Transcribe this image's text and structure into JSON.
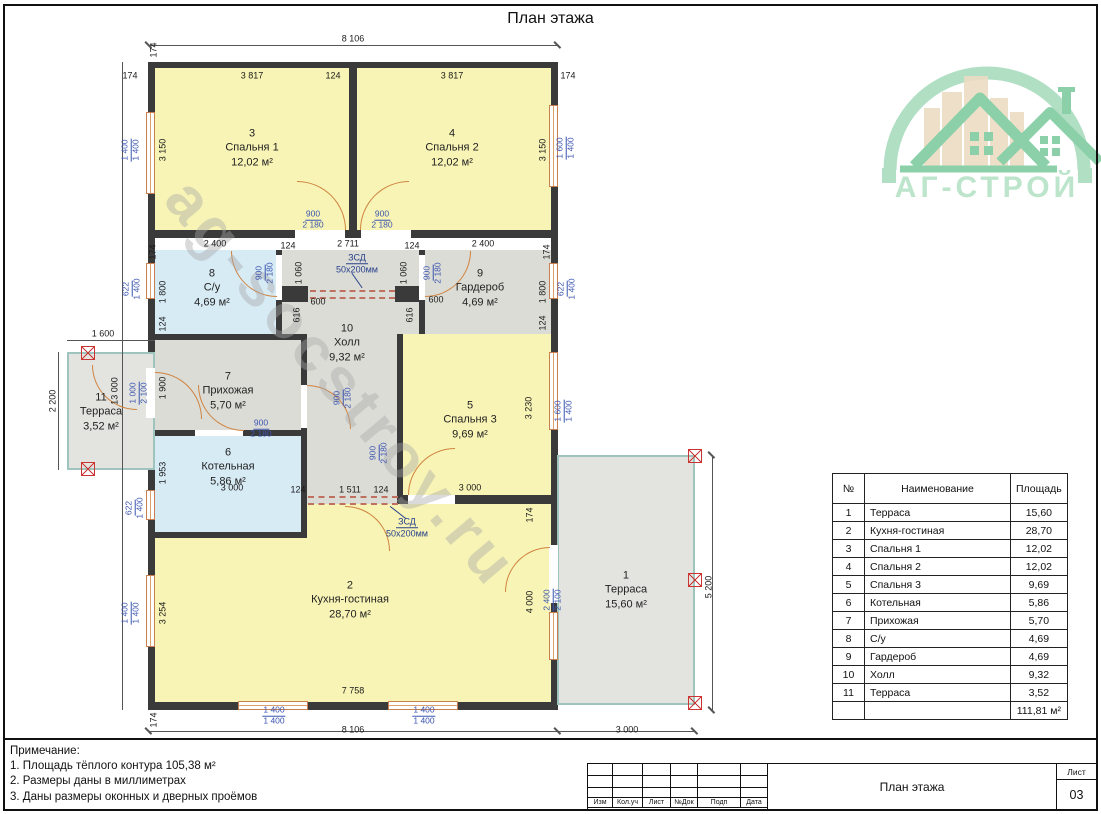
{
  "page": {
    "title": "План этажа"
  },
  "logo": {
    "name": "АГ-СТРОЙ"
  },
  "watermark": "ag-socstroy.ru",
  "plan": {
    "rooms": [
      {
        "num": "3",
        "name": "Спальня 1",
        "area": "12,02 м²"
      },
      {
        "num": "4",
        "name": "Спальня 2",
        "area": "12,02 м²"
      },
      {
        "num": "8",
        "name": "С/у",
        "area": "4,69 м²"
      },
      {
        "num": "9",
        "name": "Гардероб",
        "area": "4,69 м²"
      },
      {
        "num": "10",
        "name": "Холл",
        "area": "9,32 м²"
      },
      {
        "num": "7",
        "name": "Прихожая",
        "area": "5,70 м²"
      },
      {
        "num": "5",
        "name": "Спальня 3",
        "area": "9,69 м²"
      },
      {
        "num": "6",
        "name": "Котельная",
        "area": "5,86 м²"
      },
      {
        "num": "2",
        "name": "Кухня-гостиная",
        "area": "28,70 м²"
      },
      {
        "num": "11",
        "name": "Терраса",
        "area": "3,52 м²"
      },
      {
        "num": "1",
        "name": "Терраса",
        "area": "15,60 м²"
      }
    ],
    "dims": [
      "8 106",
      "174",
      "174",
      "3 817",
      "124",
      "3 817",
      "174",
      "3 150",
      "1 400",
      "1 400",
      "3 150",
      "1 600",
      "1 400",
      "900",
      "2 180",
      "900",
      "2 180",
      "2 400",
      "124",
      "2 711",
      "124",
      "2 400",
      "174",
      "174",
      "1 060",
      "1 060",
      "900",
      "2 180",
      "900",
      "2 180",
      "1 800",
      "622",
      "1 400",
      "1 800",
      "622",
      "1 400",
      "ЗСД",
      "50х200мм",
      "600",
      "616",
      "600",
      "616",
      "124",
      "124",
      "1 600",
      "2 200",
      "13 000",
      "1 900",
      "1 000",
      "2 100",
      "900",
      "2 180",
      "900",
      "2 180",
      "3 230",
      "1 600",
      "1 400",
      "900",
      "2 180",
      "1 953",
      "622",
      "1 400",
      "3 000",
      "124",
      "1 511",
      "124",
      "3 000",
      "ЗСД",
      "50х200мм",
      "174",
      "3 254",
      "1 400",
      "1 400",
      "4 000",
      "2 400",
      "2 100",
      "5 200",
      "3 000",
      "7 758",
      "8 106",
      "1 400",
      "1 400",
      "1 400",
      "1 400",
      "174"
    ]
  },
  "table": {
    "headers": [
      "№",
      "Наименование",
      "Площадь"
    ],
    "rows": [
      {
        "num": "1",
        "name": "Терраса",
        "area": "15,60"
      },
      {
        "num": "2",
        "name": "Кухня-гостиная",
        "area": "28,70"
      },
      {
        "num": "3",
        "name": "Спальня 1",
        "area": "12,02"
      },
      {
        "num": "4",
        "name": "Спальня 2",
        "area": "12,02"
      },
      {
        "num": "5",
        "name": "Спальня 3",
        "area": "9,69"
      },
      {
        "num": "6",
        "name": "Котельная",
        "area": "5,86"
      },
      {
        "num": "7",
        "name": "Прихожая",
        "area": "5,70"
      },
      {
        "num": "8",
        "name": "С/у",
        "area": "4,69"
      },
      {
        "num": "9",
        "name": "Гардероб",
        "area": "4,69"
      },
      {
        "num": "10",
        "name": "Холл",
        "area": "9,32"
      },
      {
        "num": "11",
        "name": "Терраса",
        "area": "3,52"
      }
    ],
    "total": "111,81 м²"
  },
  "notes": {
    "title": "Примечание:",
    "items": [
      "1. Площадь тёплого контура 105,38 м²",
      "2. Размеры даны в миллиметрах",
      "3. Даны размеры оконных и дверных проёмов"
    ]
  },
  "titleblock": {
    "columns": [
      "Изм",
      "Кол.уч",
      "Лист",
      "№Док",
      "Подп",
      "Дата"
    ],
    "doc_title": "План этажа",
    "sheet_label": "Лист",
    "sheet_number": "03"
  }
}
